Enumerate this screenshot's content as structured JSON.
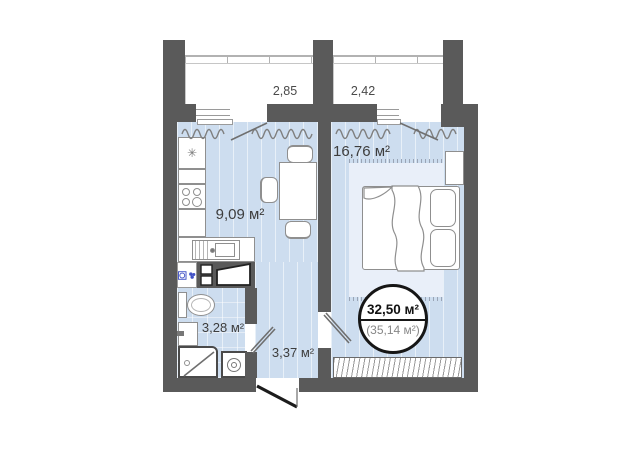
{
  "colors": {
    "wall": "#5a5a5a",
    "floor": "#cdddef",
    "rug": "#e9eff9",
    "line": "#8f8f8f",
    "accent": "#4252c6",
    "text": "#3d3d3d",
    "text-muted": "#878787",
    "badge-border": "#161616"
  },
  "balconies": [
    {
      "label": "2,85"
    },
    {
      "label": "2,42"
    }
  ],
  "rooms": {
    "kitchen": {
      "area": "9,09 м²"
    },
    "bedroom": {
      "area": "16,76 м²"
    },
    "bathroom": {
      "area": "3,28 м²"
    },
    "hallway": {
      "area": "3,37 м²"
    }
  },
  "badge": {
    "living_area": "32,50 м²",
    "total_area": "(35,14 м²)"
  },
  "glyphs": {
    "snowflake": "✳"
  }
}
